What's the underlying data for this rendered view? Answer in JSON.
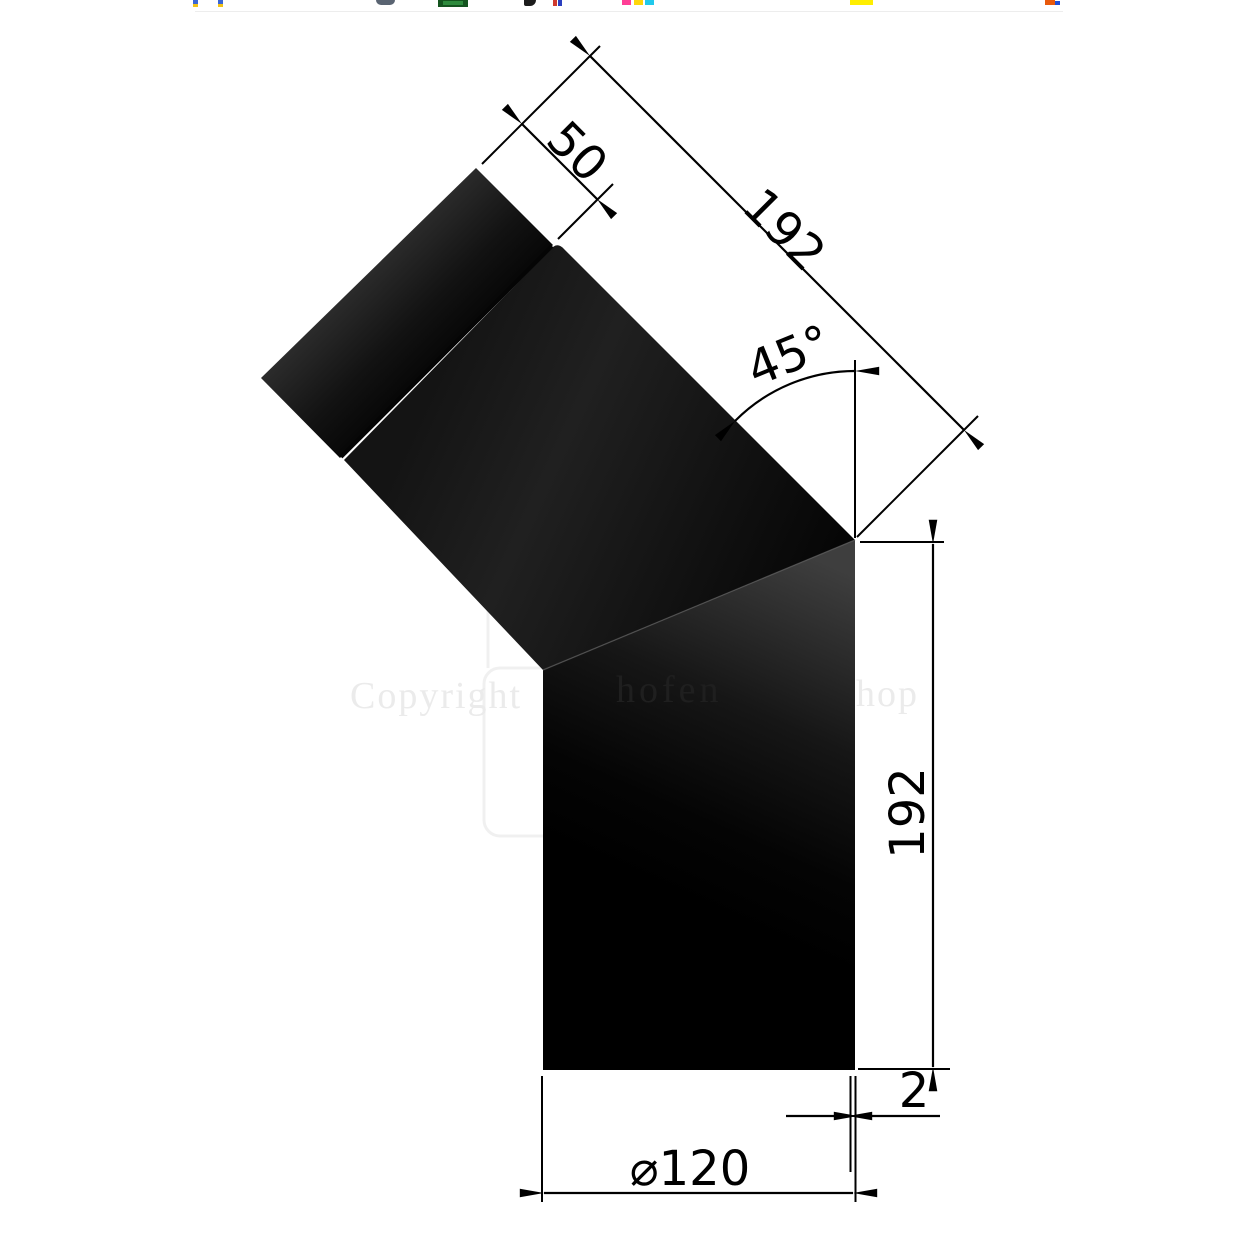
{
  "watermark": {
    "left": "Copyright",
    "middle": "hofen",
    "right": "hop"
  },
  "dimensions": {
    "collar_length": "50",
    "upper_segment_length": "192",
    "bend_angle": "45°",
    "lower_segment_length": "192",
    "wall_thickness": "2",
    "diameter": "⌀120"
  },
  "colors": {
    "background": "#ffffff",
    "drawing_line": "#000000",
    "pipe_black": "#060606",
    "pipe_sheen": "#3e3e3e",
    "watermark_light": "#ebebeb",
    "watermark_dark": "#1f1f1f",
    "hairline": "#ededed"
  },
  "top_strip": {
    "fragments": [
      {
        "x": 193,
        "y": 0,
        "w": 5,
        "h": 4,
        "c": "#3a66d6"
      },
      {
        "x": 193,
        "y": 4,
        "w": 5,
        "h": 3,
        "c": "#f2c318"
      },
      {
        "x": 218,
        "y": 0,
        "w": 5,
        "h": 4,
        "c": "#3a66d6"
      },
      {
        "x": 218,
        "y": 4,
        "w": 5,
        "h": 3,
        "c": "#f2c318"
      },
      {
        "x": 376,
        "y": 0,
        "w": 19,
        "h": 5,
        "c": "#5a6472",
        "r": "0 0 10px 10px"
      },
      {
        "x": 438,
        "y": 0,
        "w": 30,
        "h": 7,
        "c": "#14541f"
      },
      {
        "x": 443,
        "y": 1,
        "w": 20,
        "h": 4,
        "c": "#2e8b3d"
      },
      {
        "x": 524,
        "y": 0,
        "w": 12,
        "h": 6,
        "c": "#1c1c1c",
        "r": "0 0 6px 2px"
      },
      {
        "x": 553,
        "y": 0,
        "w": 4,
        "h": 6,
        "c": "#d03a2e"
      },
      {
        "x": 558,
        "y": 0,
        "w": 4,
        "h": 6,
        "c": "#2b3fbf"
      },
      {
        "x": 622,
        "y": 0,
        "w": 9,
        "h": 5,
        "c": "#ff3e96"
      },
      {
        "x": 634,
        "y": 0,
        "w": 9,
        "h": 5,
        "c": "#ffd60a"
      },
      {
        "x": 645,
        "y": 0,
        "w": 9,
        "h": 5,
        "c": "#20c9ec"
      },
      {
        "x": 850,
        "y": 0,
        "w": 23,
        "h": 5,
        "c": "#ffee00"
      },
      {
        "x": 1045,
        "y": 0,
        "w": 10,
        "h": 5,
        "c": "#e8590c"
      },
      {
        "x": 1055,
        "y": 1,
        "w": 5,
        "h": 4,
        "c": "#1d4ed8"
      },
      {
        "x": 195,
        "y": 11,
        "w": 868,
        "h": 1,
        "c": "#ededed"
      }
    ]
  }
}
